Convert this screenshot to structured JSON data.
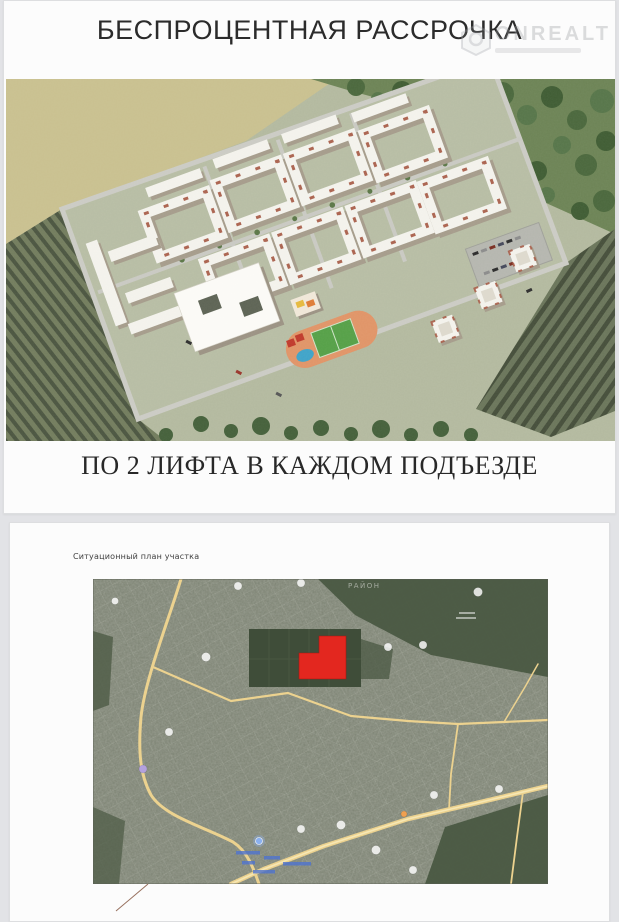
{
  "card1": {
    "title": "БЕСПРОЦЕНТНАЯ РАССРОЧКА",
    "subtitle": "ПО 2 ЛИФТА В КАЖДОМ ПОДЪЕЗДЕ"
  },
  "watermark": {
    "text": "ONREALT"
  },
  "card2": {
    "plan_label": "Ситуационный план участка",
    "map": {
      "district_label": "РАЙОН",
      "site_color": "#e3271f",
      "road_color": "#ecd28f"
    }
  }
}
